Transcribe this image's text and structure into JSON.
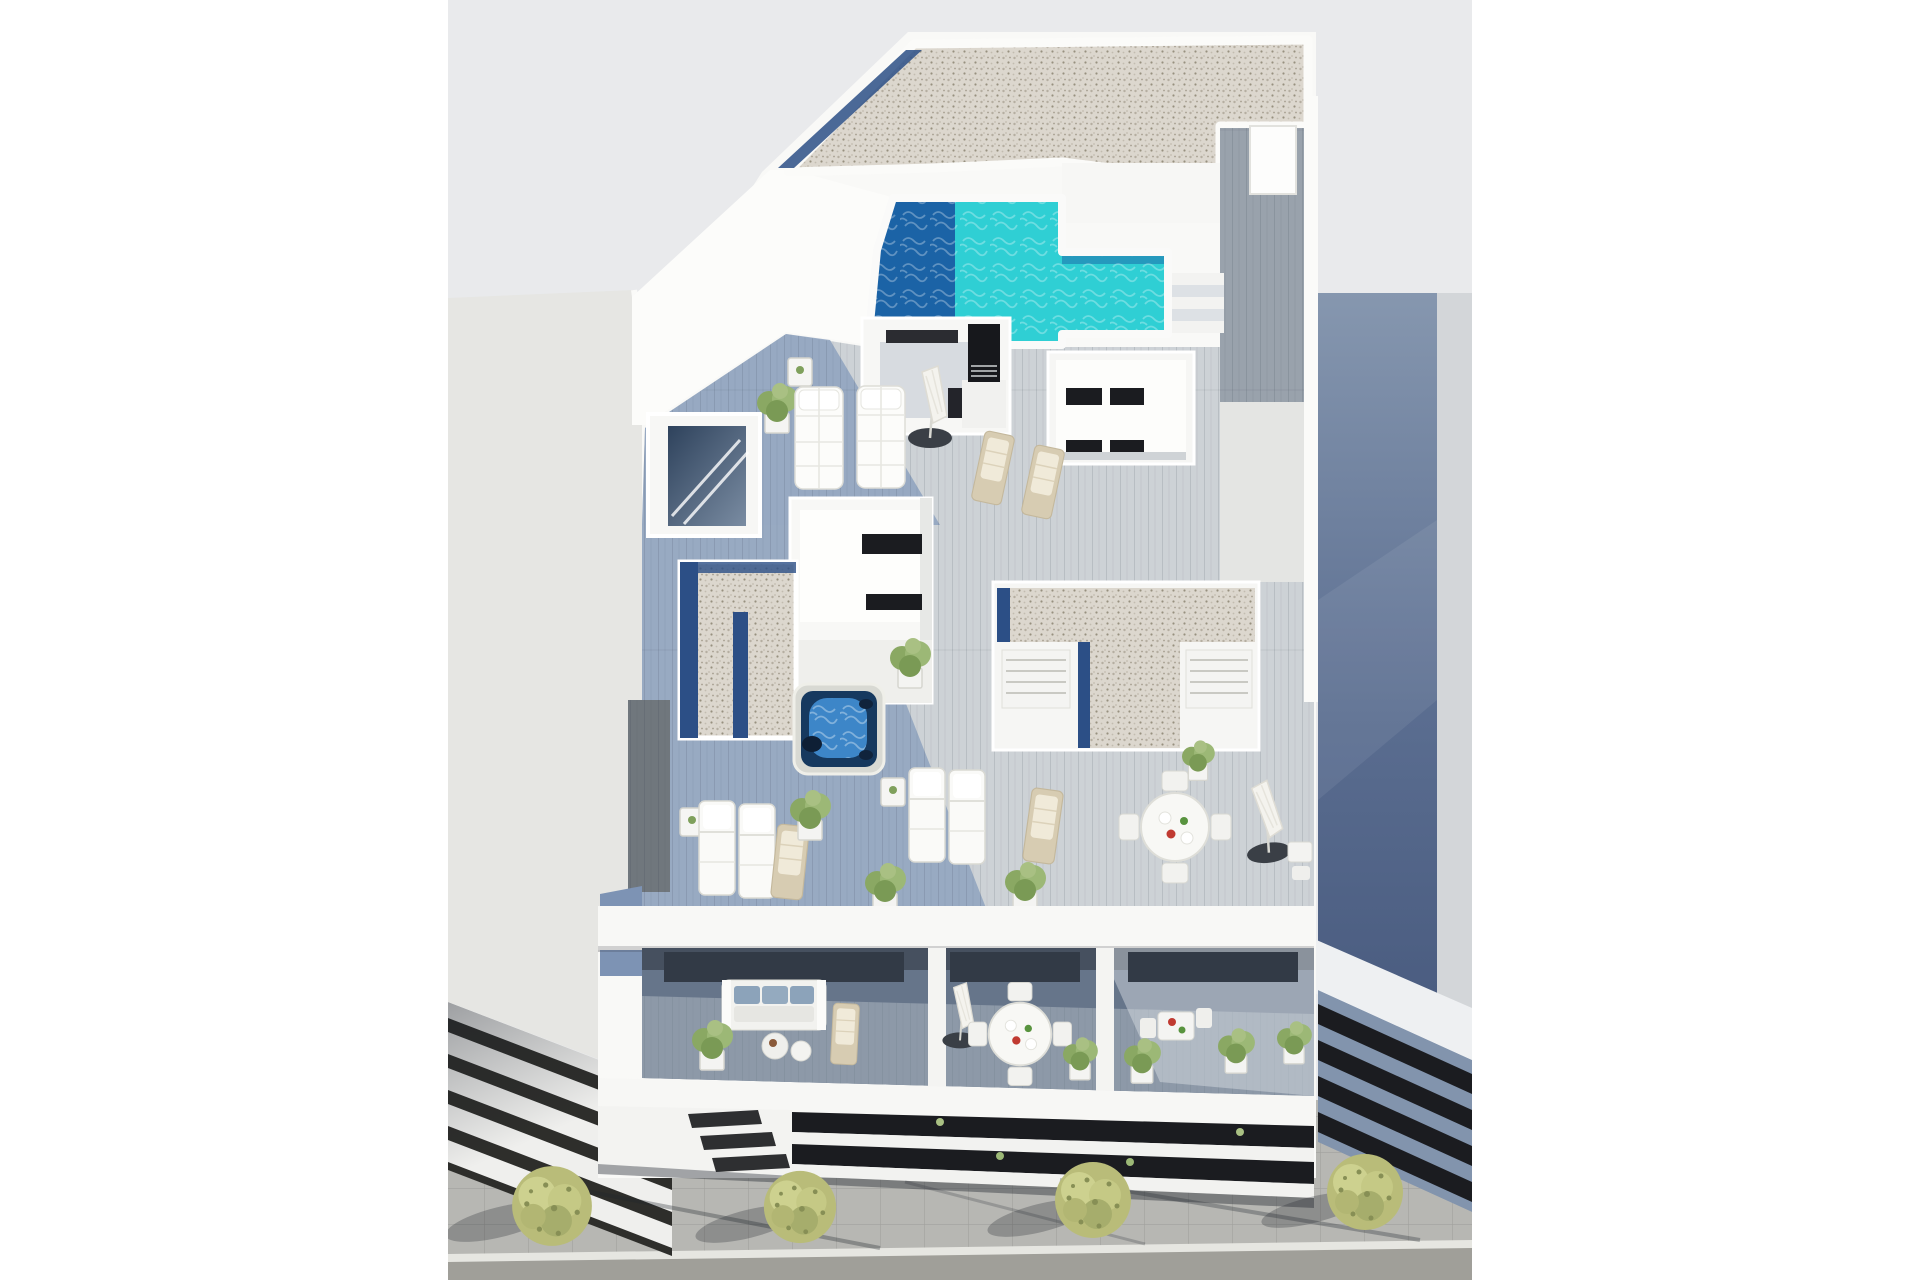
{
  "image": {
    "type": "3d-architectural-render",
    "description": "Aerial 3D rendering of a modern white apartment building with rooftop swimming pool, solarium decks with sun loungers, jacuzzi, penthouse terraces, balconies with outdoor furniture, neighbouring buildings and a street with trees",
    "width": 1920,
    "height": 1280
  },
  "scene": {
    "title": "Aerial render - apartment building with rooftop pool",
    "labels": {
      "background": "Sky / backdrop",
      "left_building": "Neighbouring building (left)",
      "left_building_facade": "Balcony slabs of left building",
      "right_building": "Neighbouring building (right)",
      "right_building_facade": "Louvered facade of right building",
      "main_building": "Main apartment building",
      "gravel_roof": "Gravel roof",
      "pool": "Rooftop swimming pool",
      "pool_steps": "Pool steps",
      "roof_walkway": "Roof access walkway",
      "roof_door": "Roof access door",
      "solarium": "Solarium deck with daybeds",
      "chimney": "Ventilation chimney",
      "stair_skylight": "Stairwell skylight",
      "roof_courtyard": "Rooftop courtyard volume",
      "gravel_strip": "Lower gravel roof",
      "storage_volume": "Roof volume with louvered doors",
      "jacuzzi": "Jacuzzi hot tub",
      "terrace": "Penthouse terrace with loungers",
      "dining_set": "Outdoor dining set",
      "balconies": "Apartment balconies",
      "sofa": "Outdoor sofa with blue cushions",
      "facade": "Street facade with glazing bands",
      "street": "Street with sidewalk and trees",
      "tree": "Street tree"
    }
  },
  "colors": {
    "page_bg": "#ffffff",
    "render_bg": "#e9eaec",
    "wall_white": "#f9f9f7",
    "wall_bright": "#fcfcfa",
    "left_wall": "#e6e6e3",
    "slab_base": "#efefed",
    "slab_dark": "#2e2e2b",
    "pool_turquoise": "#2fcfd4",
    "pool_deep": "#1b63a6",
    "drain_navy": "#2c4f86",
    "deck_sun": "#cdd2d6",
    "deck_shade": "#8ba0bd",
    "deck_light": "#e4e5e3",
    "corridor_wood": "#99a2ac",
    "dark_flank": "#70777d",
    "flank_blue": "#7d93b4",
    "glass_dark": "#1b1c20",
    "rb_strip": "#d3d6d9",
    "louver_slab": "#8294ad",
    "jacuzzi_shell": "#d8d9d3",
    "jacuzzi_water": "#3d86c8",
    "jacuzzi_deep": "#16395f",
    "chimney_black": "#17181c",
    "parapet_white": "#f8f8f6",
    "recess_wall": "#66758a",
    "recess_floor": "#8d99a8",
    "soffit_shadow": "#46505f",
    "glass_door": "#323a46",
    "facade_left": "#f3f3f1",
    "slot_dark": "#2e2f31",
    "sidewalk": "#b7b7b3",
    "curb": "#e6e6e1",
    "road": "#a09f99",
    "shadow": "#1f242c",
    "tree_base": "#b9bc79",
    "table_red": "#c03a31",
    "table_green": "#58933e"
  }
}
